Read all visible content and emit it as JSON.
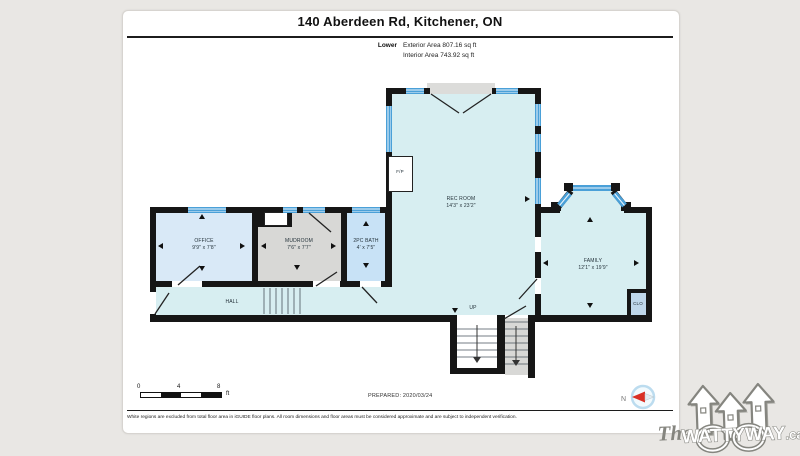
{
  "header": {
    "title": "140 Aberdeen Rd, Kitchener, ON",
    "floor_label": "Lower",
    "exterior_area": "Exterior Area 807.16 sq ft",
    "interior_area": "Interior Area 743.92 sq ft"
  },
  "rooms": {
    "office": {
      "name": "OFFICE",
      "dims": "9'9\" x 7'8\""
    },
    "mudroom": {
      "name": "MUDROOM",
      "dims": "7'6\" x 7'7\""
    },
    "bath": {
      "name": "2PC BATH",
      "dims": "4' x 7'5\""
    },
    "rec_room": {
      "name": "REC ROOM",
      "dims": "14'3\" x 23'2\""
    },
    "family": {
      "name": "FAMILY",
      "dims": "12'1\" x 19'9\""
    },
    "hall": {
      "name": "HALL"
    },
    "closet": {
      "name": "CLO"
    },
    "fireplace": {
      "name": "F/P"
    },
    "stairs_up": {
      "name": "UP"
    }
  },
  "footer": {
    "scale": {
      "tick0": "0",
      "tick4": "4",
      "tick8": "8",
      "unit": "ft"
    },
    "prepared": "PREPARED: 2020/03/24",
    "compass_north": "N",
    "disclaimer": "White regions are excluded from total floor area in iGUIDE floor plans. All room dimensions and floor areas must be considered approximate and are subject to independent verification."
  },
  "watermark": {
    "prefix": "The",
    "brand": "WATTYWAY",
    "suffix": ".ca"
  },
  "colors": {
    "wall": "#161616",
    "room_cyan": "#d7eef1",
    "room_blue": "#d9e9f7",
    "room_bath": "#c8e2f6",
    "room_gray": "#d8d8d6",
    "closet_blue": "#bfd7ea",
    "window_blue": "#4aa0d8",
    "compass_red": "#d93025"
  }
}
